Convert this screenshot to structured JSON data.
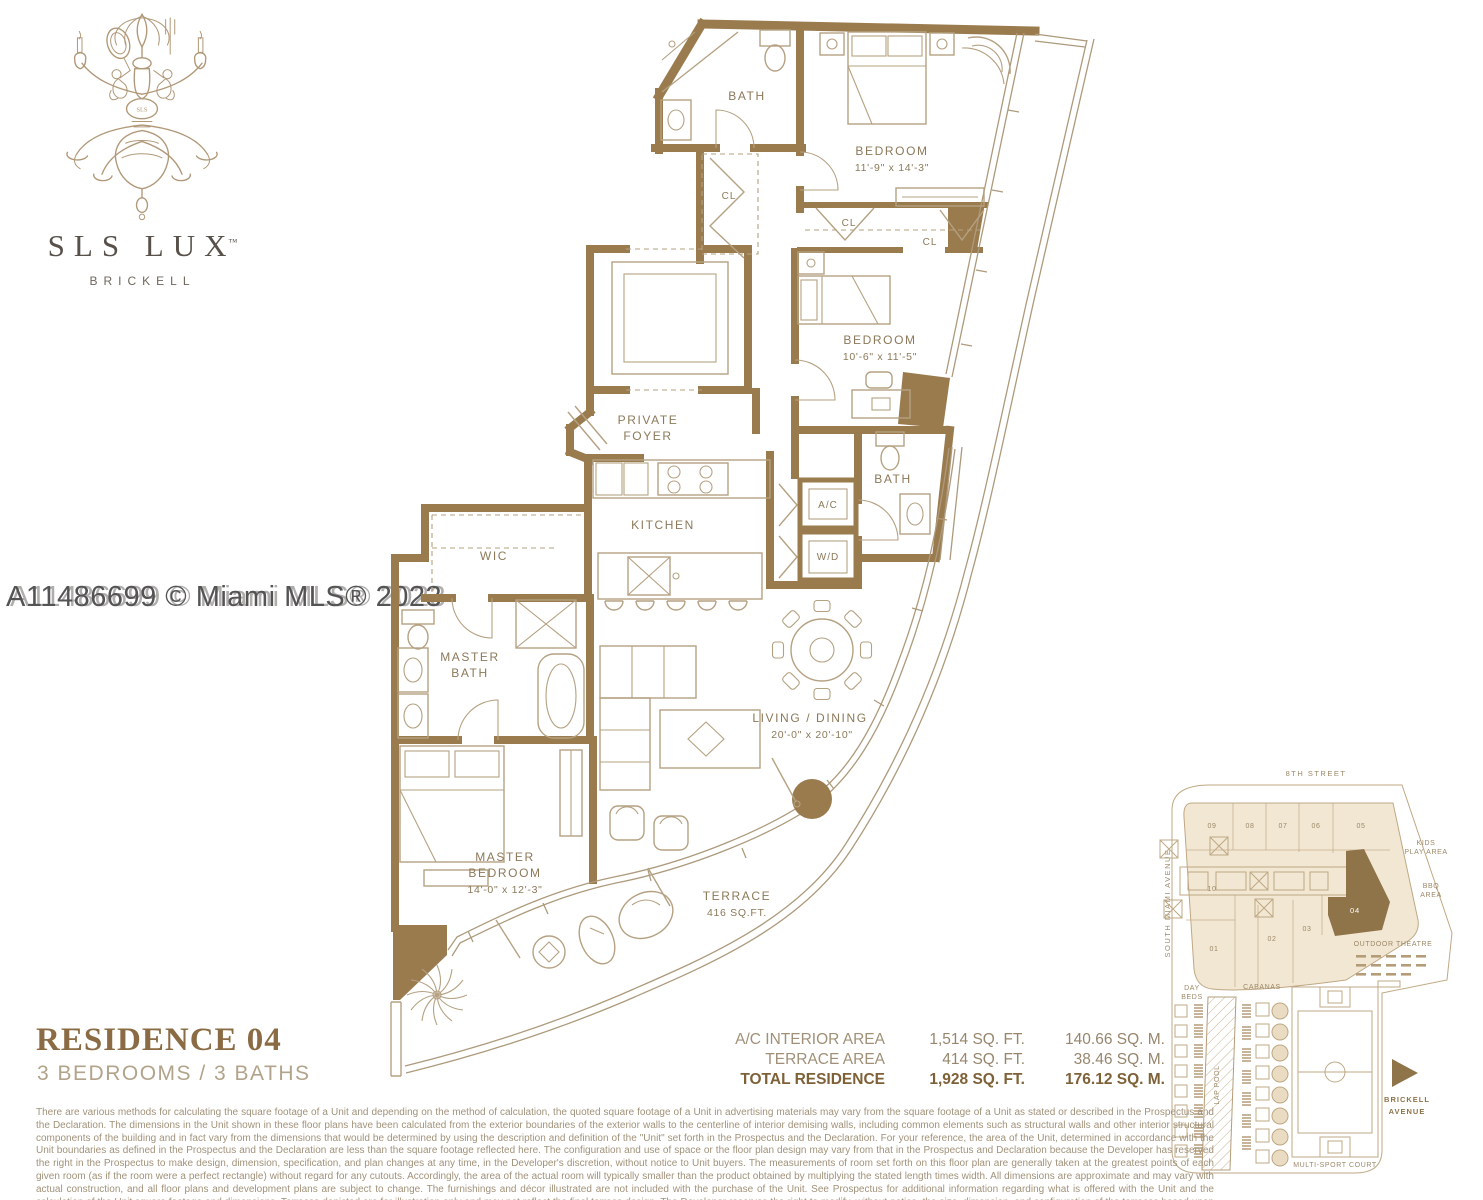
{
  "logo": {
    "brand": "SLS LUX",
    "tm": "™",
    "location": "BRICKELL"
  },
  "watermark": "A11486699 © Miami MLS® 2023",
  "plan": {
    "bath1": "BATH",
    "bedroom1": {
      "name": "BEDROOM",
      "dims": "11'-9\" x 14'-3\""
    },
    "cl1": "CL",
    "cl2": "CL",
    "cl3": "CL",
    "bedroom2": {
      "name": "BEDROOM",
      "dims": "10'-6\" x 11'-5\""
    },
    "foyer": {
      "l1": "PRIVATE",
      "l2": "FOYER"
    },
    "kitchen": "KITCHEN",
    "wic": "WIC",
    "master_bath": {
      "l1": "MASTER",
      "l2": "BATH"
    },
    "bath2": "BATH",
    "ac": "A/C",
    "wd": "W/D",
    "living": {
      "name": "LIVING / DINING",
      "dims": "20'-0\" x 20'-10\""
    },
    "master_bedroom": {
      "l1": "MASTER",
      "l2": "BEDROOM",
      "dims": "14'-0\" x 12'-3\""
    },
    "terrace": {
      "l1": "TERRACE",
      "l2": "416 SQ.FT."
    }
  },
  "residence": {
    "title": "RESIDENCE 04",
    "subtitle": "3 BEDROOMS / 3 BATHS"
  },
  "areas": {
    "rows": [
      {
        "label": "A/C INTERIOR AREA",
        "ft": "1,514 SQ. FT.",
        "m": "140.66 SQ. M."
      },
      {
        "label": "TERRACE AREA",
        "ft": "414 SQ. FT.",
        "m": "38.46 SQ. M."
      },
      {
        "label": "TOTAL RESIDENCE",
        "ft": "1,928 SQ. FT.",
        "m": "176.12 SQ. M."
      }
    ]
  },
  "siteplan": {
    "street_top": "8TH STREET",
    "street_left": "SOUTH MIAMI AVENUE",
    "units": {
      "u09": "09",
      "u08": "08",
      "u07": "07",
      "u06": "06",
      "u05": "05",
      "u10": "10",
      "u01": "01",
      "u02": "02",
      "u03": "03",
      "u04": "04"
    },
    "kids": {
      "l1": "KIDS",
      "l2": "PLAY AREA"
    },
    "bbq": {
      "l1": "BBQ",
      "l2": "AREA"
    },
    "outdoor_theatre": "OUTDOOR THEATRE",
    "day_beds": {
      "l1": "DAY",
      "l2": "BEDS"
    },
    "cabanas": "CABANAS",
    "lap_pool": "LAP POOL",
    "court": "MULTI-SPORT COURT",
    "brickell": {
      "l1": "BRICKELL",
      "l2": "AVENUE"
    }
  },
  "disclaimer": "There are various methods for calculating the square footage of a Unit and depending on the method of calculation, the quoted square footage of a Unit in advertising materials may vary from the square footage of a Unit as stated or described in the Prospectus and the Declaration.  The dimensions in the Unit shown in these floor plans have been calculated from the exterior boundaries of the exterior walls to the centerline of interior demising walls, including common elements such as structural walls and other interior structural components of the building and in fact vary from the dimensions that would be determined by using the description and definition of the \"Unit\" set forth in the Prospectus and the Declaration.  For your reference, the area of the Unit, determined in accordance with the Unit boundaries as defined in the Prospectus and the Declaration are less than the square footage reflected here.  The configuration and use of space or the floor plan design may vary from that in the Prospectus and Declaration because the Developer has reserved the right in the Prospectus to make design, dimension, specification, and plan changes at any time, in the Developer's discretion, without notice to Unit buyers.  The measurements of room set forth on this floor plan are generally taken at the greatest points of each given room (as if the room were a perfect rectangle) without regard for any cutouts.  Accordingly, the area of the actual room will typically smaller than the product obtained by multiplying the stated length times width.  All dimensions are approximate and may vary with actual construction, and all floor plans and development plans are subject to change.  The furnishings and décor illustrated are not included with the purchase of the Unit.  See Prospectus for additional information regarding what is offered with the Unit and the calculation of the Unit square footage and dimensions.  Terraces depicted are for illustration only and may not reflect the final terrace design. The Developer reserves the right to modify, without notice, the size, dimension, and configuration of the terraces based upon the final architectural and engineering specifications.",
  "colors": {
    "wall": "#9a7b4e",
    "accent": "#8a6b43",
    "line": "#b5a182",
    "site_highlight": "#8f744a"
  }
}
